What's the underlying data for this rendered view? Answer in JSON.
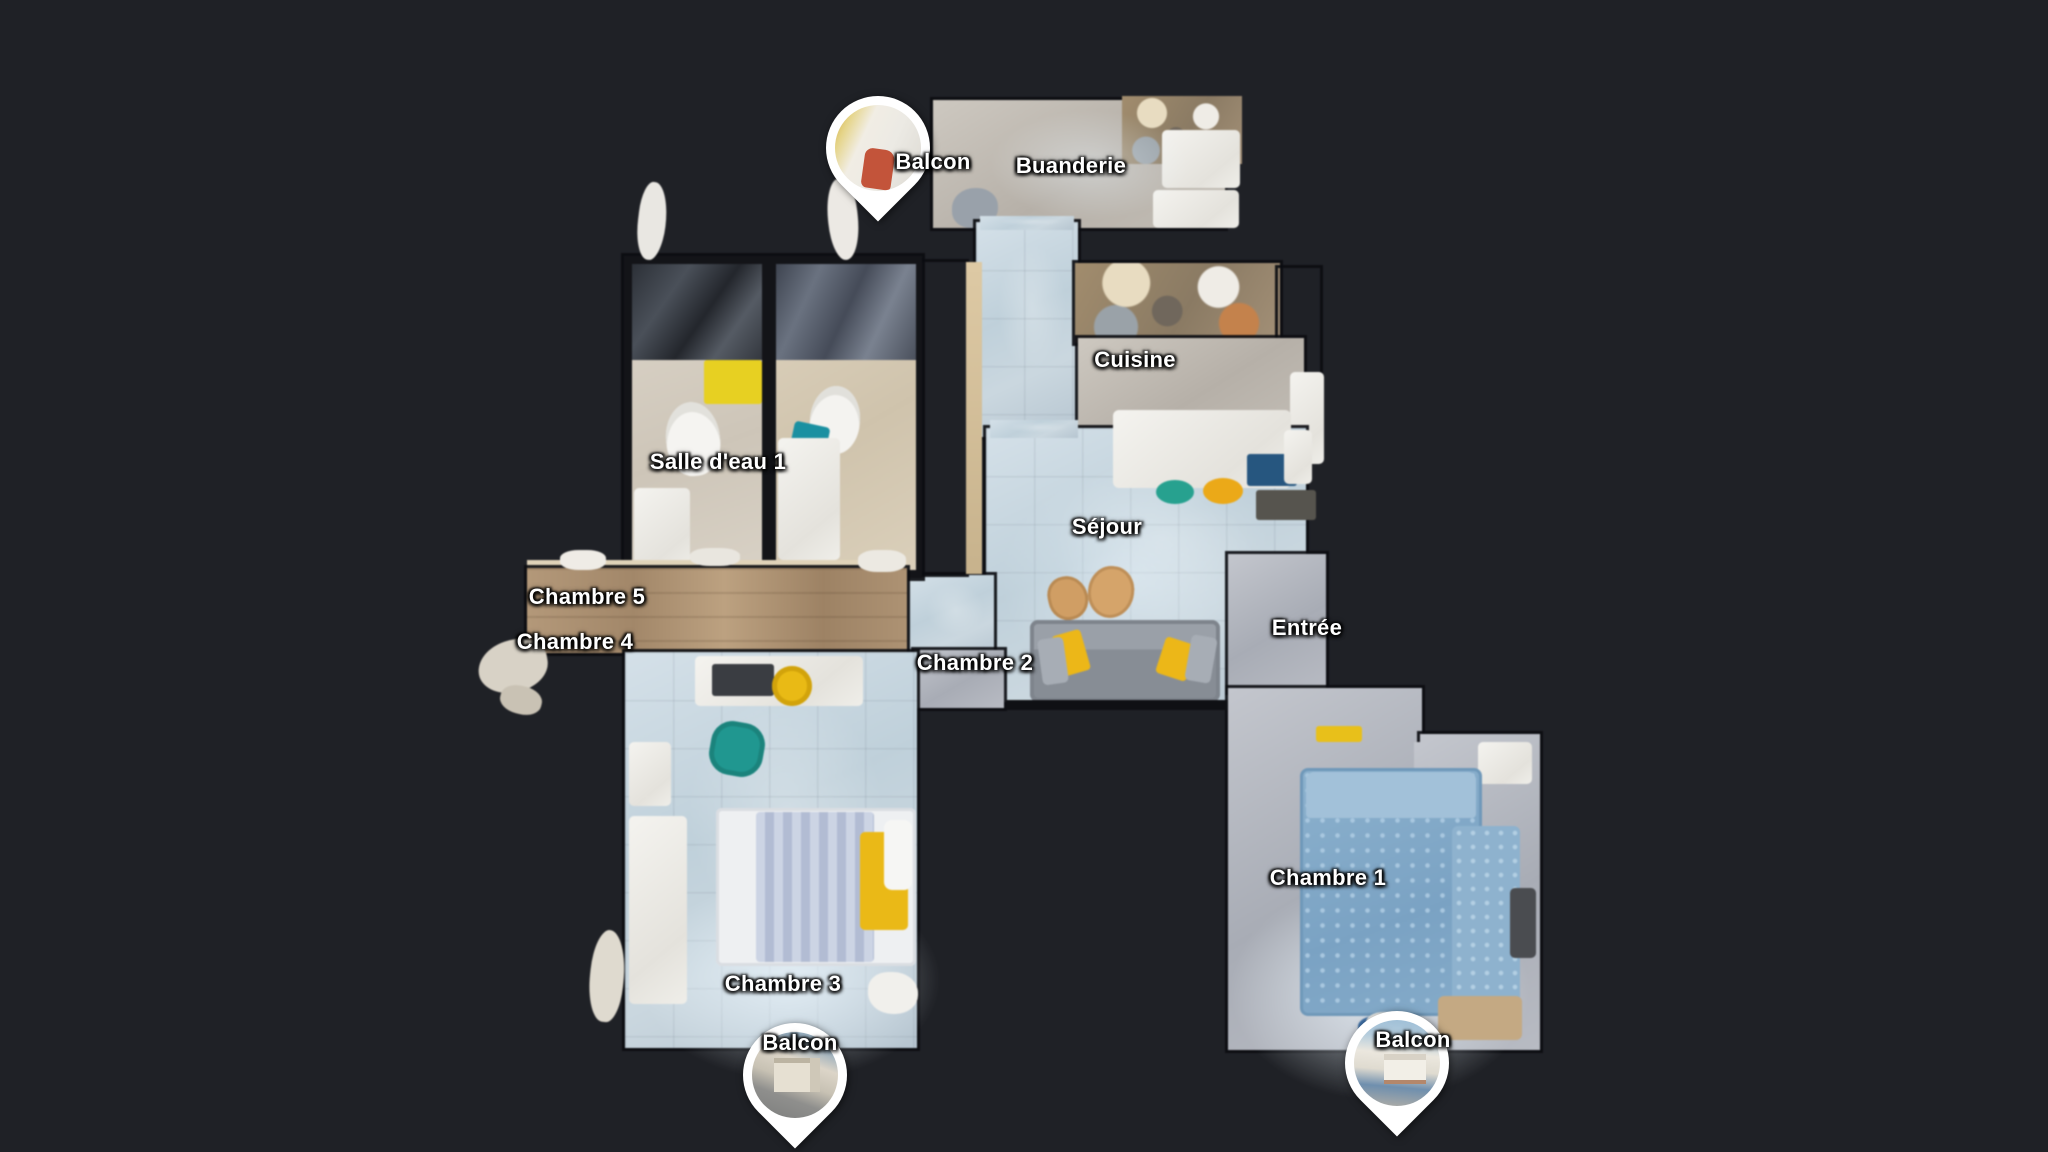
{
  "view": {
    "type": "3d-dollhouse-floorplan",
    "background_color": "#1f2126"
  },
  "rooms": {
    "balcon_top": "Balcon",
    "buanderie": "Buanderie",
    "cuisine": "Cuisine",
    "salle_deau_1": "Salle d'eau 1",
    "sejour": "Séjour",
    "chambre_5": "Chambre 5",
    "chambre_4": "Chambre 4",
    "chambre_2": "Chambre 2",
    "entree": "Entrée",
    "chambre_1": "Chambre 1",
    "chambre_3": "Chambre 3",
    "balcon_bottom_left": "Balcon",
    "balcon_bottom_right": "Balcon"
  },
  "pins": {
    "top": {
      "photo_icon": "balcony-interior-photo"
    },
    "bottom_left": {
      "photo_icon": "street-facade-photo"
    },
    "bottom_right": {
      "photo_icon": "house-facade-photo"
    }
  },
  "colors": {
    "background": "#1f2126",
    "floor_tile_blue": "#c6d4dd",
    "floor_beige": "#c2bcb4",
    "floor_gray": "#b0b4bc",
    "wood": "#ab9174",
    "accent_yellow": "#e8b81e",
    "accent_teal": "#23968f",
    "bed_blue": "#84aac7",
    "sofa_gray": "#8d939b",
    "label_text": "#ffffff",
    "pin_ring": "#ffffff"
  }
}
